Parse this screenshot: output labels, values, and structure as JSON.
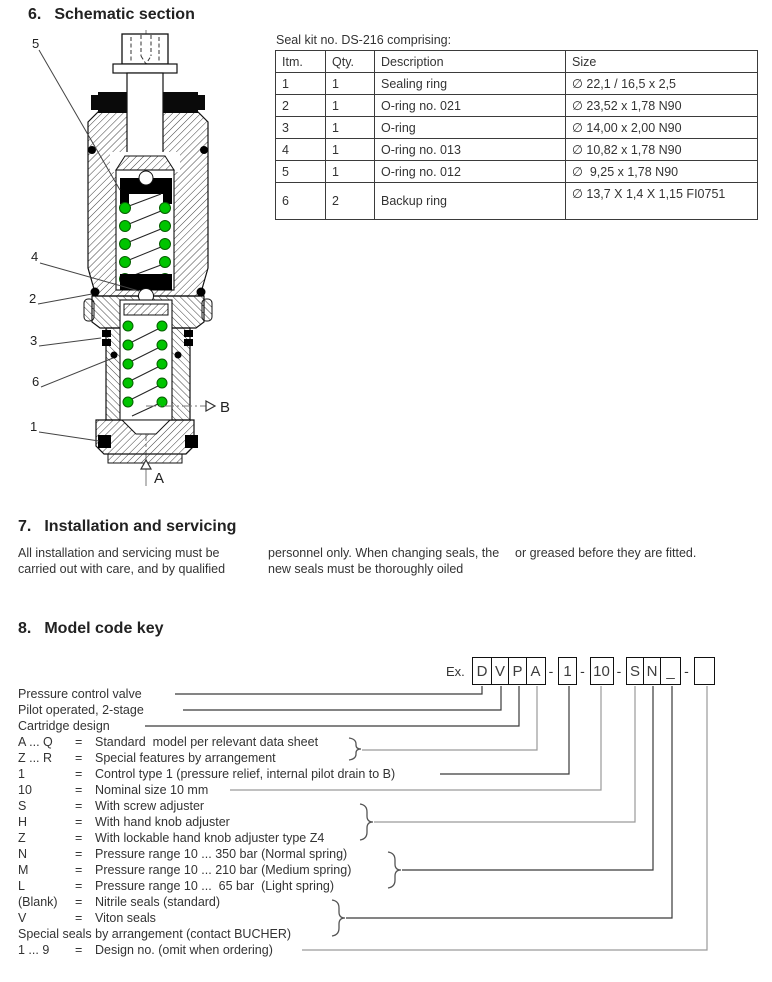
{
  "section6": {
    "number": "6.",
    "title": "Schematic section",
    "schematic": {
      "callouts": [
        "5",
        "4",
        "2",
        "3",
        "6",
        "1"
      ],
      "port_a": "A",
      "port_b": "B",
      "spring_color": "#00c400",
      "seal_color": "#000000"
    },
    "seal_kit": {
      "title": "Seal kit no. DS-216 comprising:",
      "columns": [
        "Itm.",
        "Qty.",
        "Description",
        "Size"
      ],
      "rows": [
        [
          "1",
          "1",
          "Sealing ring",
          "∅ 22,1 / 16,5 x 2,5"
        ],
        [
          "2",
          "1",
          "O-ring no. 021",
          "∅ 23,52 x 1,78 N90"
        ],
        [
          "3",
          "1",
          "O-ring",
          "∅ 14,00 x 2,00 N90"
        ],
        [
          "4",
          "1",
          "O-ring no. 013",
          "∅ 10,82 x 1,78 N90"
        ],
        [
          "5",
          "1",
          "O-ring no. 012",
          "∅  9,25 x 1,78 N90"
        ],
        [
          "6",
          "2",
          "Backup ring",
          "∅ 13,7 X 1,4 X 1,15 FI0751"
        ]
      ]
    }
  },
  "section7": {
    "number": "7.",
    "title": "Installation and servicing",
    "col1": "All installation and servicing  must be carried out with care, and by qualified",
    "col2": "personnel only. When changing seals, the new seals must be thoroughly oiled",
    "col3": "or greased before they are fitted."
  },
  "section8": {
    "number": "8.",
    "title": "Model code key",
    "example_label": "Ex.",
    "code_boxes": {
      "b1": "D",
      "b2": "V",
      "b3": "P",
      "b4": "A",
      "d1": "-",
      "b5": "1",
      "d2": "-",
      "b6": "10",
      "d3": "-",
      "b7": "S",
      "b8": "N",
      "b9": "_",
      "d4": "-",
      "b10": ""
    },
    "rows": [
      {
        "c1": "Pressure control valve",
        "c2": "",
        "c3": ""
      },
      {
        "c1": "Pilot operated, 2-stage",
        "c2": "",
        "c3": ""
      },
      {
        "c1": "Cartridge design",
        "c2": "",
        "c3": ""
      },
      {
        "c1": "A ... Q",
        "c2": "=",
        "c3": "Standard  model per relevant data sheet"
      },
      {
        "c1": "Z ... R",
        "c2": "=",
        "c3": "Special features by arrangement"
      },
      {
        "c1": "1",
        "c2": "=",
        "c3": "Control type 1 (pressure relief, internal pilot drain to B)"
      },
      {
        "c1": "10",
        "c2": "=",
        "c3": "Nominal size 10 mm"
      },
      {
        "c1": "S",
        "c2": "=",
        "c3": "With screw adjuster"
      },
      {
        "c1": "H",
        "c2": "=",
        "c3": "With hand knob adjuster"
      },
      {
        "c1": "Z",
        "c2": "=",
        "c3": "With lockable hand knob adjuster type Z4"
      },
      {
        "c1": "N",
        "c2": "=",
        "c3": "Pressure range 10 ... 350 bar (Normal spring)"
      },
      {
        "c1": "M",
        "c2": "=",
        "c3": "Pressure range 10 ... 210 bar (Medium spring)"
      },
      {
        "c1": "L",
        "c2": "=",
        "c3": "Pressure range 10 ...  65 bar  (Light spring)"
      },
      {
        "c1": "(Blank)",
        "c2": "=",
        "c3": "Nitrile seals (standard)"
      },
      {
        "c1": "V",
        "c2": "=",
        "c3": "Viton seals"
      },
      {
        "c1": "Special seals by arrangement (contact BUCHER)",
        "c2": "",
        "c3": ""
      },
      {
        "c1": "1 ... 9",
        "c2": "=",
        "c3": "Design no. (omit when ordering)"
      }
    ]
  }
}
